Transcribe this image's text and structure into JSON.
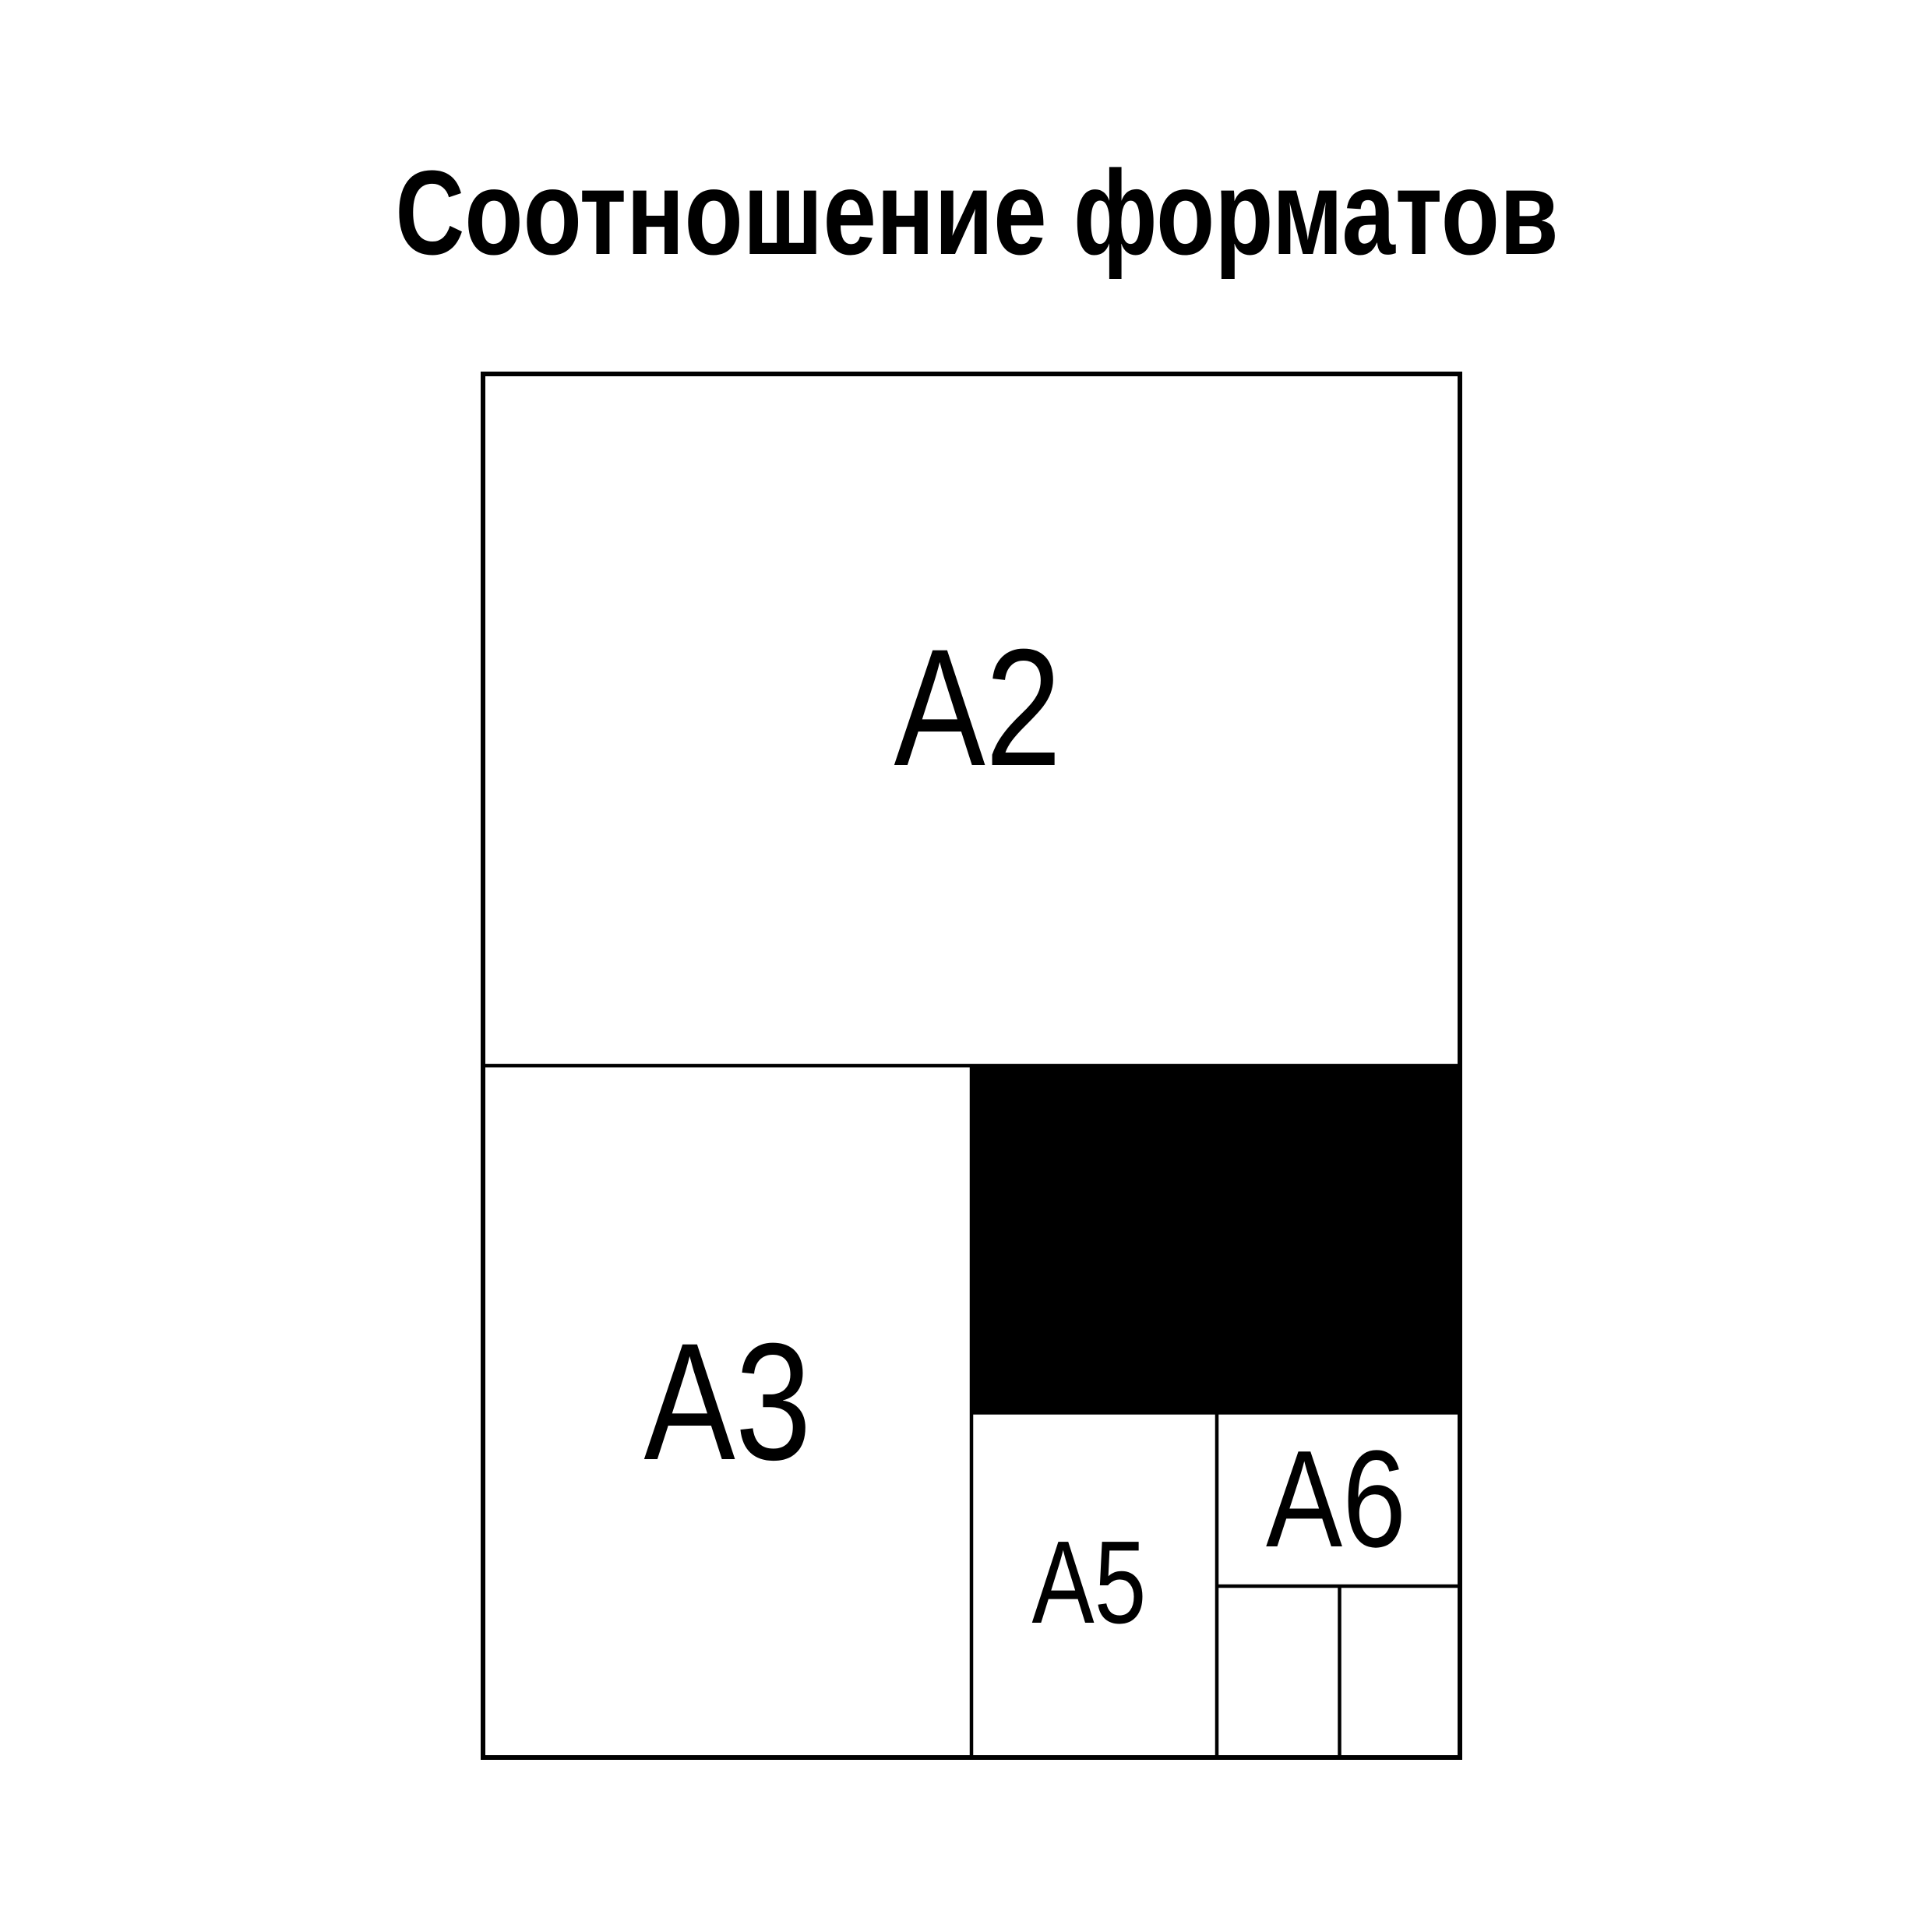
{
  "title": "Соотношение форматов",
  "colors": {
    "background": "#ffffff",
    "line": "#000000",
    "title_text": "#000000",
    "label_text": "#000000",
    "a4_fill": "#000000",
    "a4_label_text": "#ffffff"
  },
  "formats": [
    {
      "label": "A2",
      "filled": false
    },
    {
      "label": "A3",
      "filled": false
    },
    {
      "label": "A4",
      "filled": true
    },
    {
      "label": "A5",
      "filled": false
    },
    {
      "label": "A6",
      "filled": false
    }
  ]
}
